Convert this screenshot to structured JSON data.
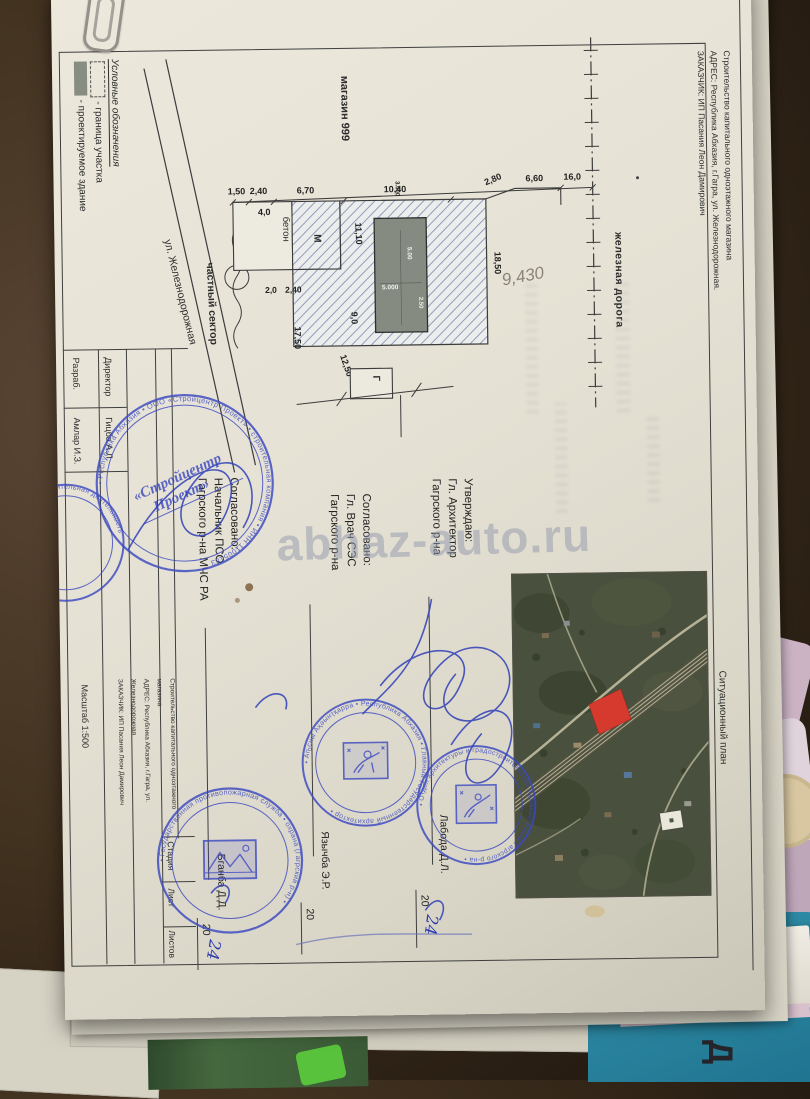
{
  "doc": {
    "edge_title": {
      "line1": "Строительство капитального одноэтажного магазина",
      "line2": "АДРЕС: Республика Абхазия, г.Гагра, ул. Железнодорожная.",
      "line3": "ЗАКАЗЧИК: ИП Пасания Леон Дамирович"
    },
    "legend": {
      "heading": "Условные обозначения",
      "boundary_label": "- граница участка",
      "building_label": "- проектируемое здание"
    },
    "plan": {
      "shop_label": "магазин 999",
      "street_label": "ул. Железнодорожная",
      "private_sector_label": "частный сектор",
      "railway_label": "железная дорога",
      "concrete_label": "бетон",
      "m_label": "М",
      "g_label": "Г",
      "handwritten_area": "9,430",
      "dims": {
        "t1": "1,50",
        "t2": "2,40",
        "t3": "6,70",
        "t4": "10,40",
        "t5": "2,80",
        "t6": "6,60",
        "t7": "16,0",
        "w40": "4,0",
        "v1850": "18,50",
        "v1110": "11,10",
        "l20": "2,0",
        "l240": "2,40",
        "v1750": "17,50",
        "v90": "9,0",
        "d1250": "12,50",
        "b1": "3.000",
        "b2": "5.00",
        "b3": "5.000",
        "b4": "2.50"
      }
    },
    "approvals": {
      "approve": {
        "l1": "Утверждаю:",
        "l2": "Гл. Архитектор",
        "l3": "Гагрского р-на",
        "name": "Лабода Д.Л.",
        "year": "20",
        "hand": "24"
      },
      "ses": {
        "l1": "Согласовано:",
        "l2": "Гл. Врач СЭС",
        "l3": "Гагрского р-на",
        "name": "Язычба Э.Р.",
        "year": "20"
      },
      "mchs": {
        "l1": "Согласовано:",
        "l2": "Начальник ПСО",
        "l3": "Гагрского р-на МЧС РА",
        "name": "Бганба Д.Д.",
        "year": "20",
        "hand": "24"
      }
    },
    "titleblock": {
      "developer_label": "Разраб.",
      "developer_name": "Амлар И.З.",
      "director_label": "Директор",
      "director_name": "Гицба А.Л.",
      "project_line1": "Строительство капитального одноэтажного магазина",
      "project_line2": "АДРЕС: Республика Абхазия, г.Гагра, ул. Железнодорожная",
      "project_line3": "ЗАКАЗЧИК: ИП Пасания Леон Дамирович",
      "stage_label": "Стадия",
      "sheet_label": "Лист",
      "sheets_label": "Листов",
      "scale_label": "Масштаб 1:500"
    },
    "sitplan_label": "Ситуационный план",
    "watermark": "abhaz-auto.ru",
    "stamps": {
      "stroycentr_c1": "«Стройцентр",
      "stroycentr_c2": "Проект»",
      "stroycentr_ring": "• Республика Абхазия • ООО «Стройцентр Проект» • строительная компания • ИНН 11005183",
      "arch1_ring": "• Аҧсны Аҳәынҭқарра • Республика Абхазия • Главный Государственный архитектор •",
      "arch2_ring": "• Отдел архитектуры и градостроительства Администрации Гагрского р-на •",
      "mchs_ring": "• Государственная противопожарная служба • охрана (Гагрский р-н) •",
      "edge_ring": "строительная деятельность"
    }
  },
  "bg": {
    "letters_sb": "СБ",
    "letter_d": "Д",
    "label_vecher": "Вечер"
  }
}
